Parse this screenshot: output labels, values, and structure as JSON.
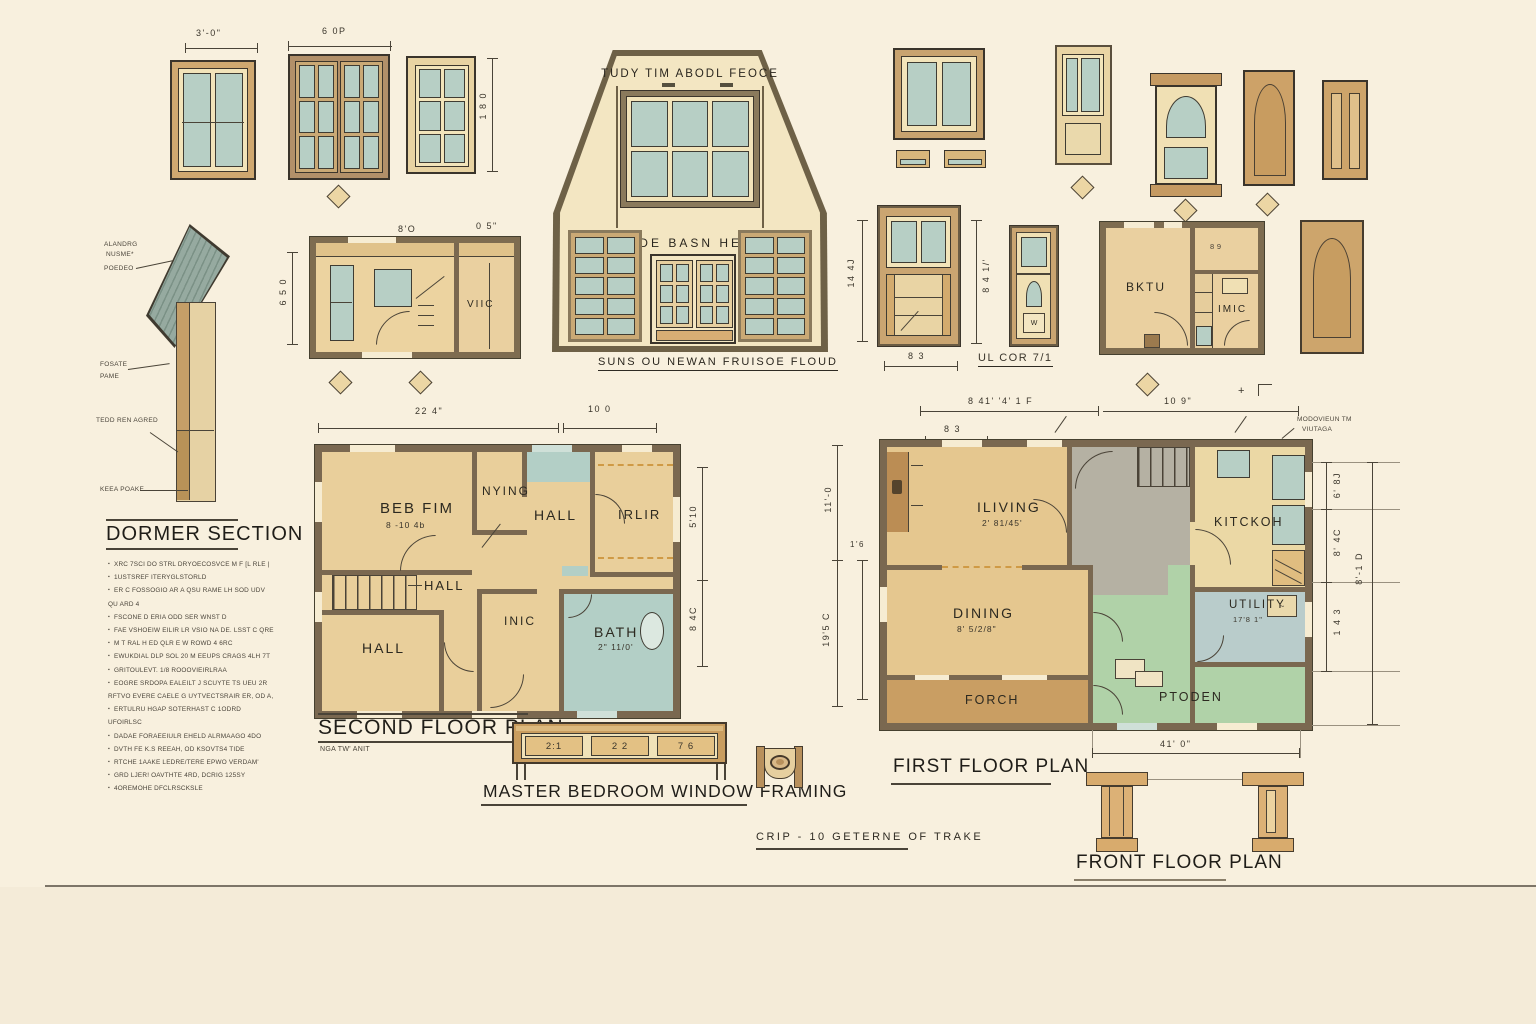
{
  "palette": {
    "paper": "#f8f0de",
    "wall": "#7a6850",
    "glass": "#b7cfc5",
    "green": "#b0d2a8",
    "gray": "#b5b1a3"
  },
  "windows": {
    "dim_a": "3'-0\"",
    "dim_b": "6 0P",
    "dim_c": "1 8 0"
  },
  "elevation": {
    "top_text": "TUDY TIM ABODL FEOCE",
    "mid_text": "BUDE BASN HETE",
    "caption": "SUNS OU NEWAN FRUISOE FLOUD"
  },
  "dormer": {
    "title": "DORMER SECTION",
    "callouts": [
      "ALANDRG",
      "NUSME*",
      "POEDEO",
      "FOSATE",
      "PAME",
      "TEDD REN AGRED",
      "KEEA POAKE"
    ],
    "notes": [
      "XRC 7SCI DO STRL DRYOECOSVCE M F  [L RLE |",
      "1USTSREF  ITERYGLSTORLD",
      "ER C FOSSOGIO AR A QSU RAME LH SOD UDV QU ARD 4",
      "FSCONE D ERIA ODD SER WNST D",
      "FAE VSHOEIW EILIR LR VSIO NA DE. LSST C QRE",
      "M T RAL H ED QLR E W ROWD 4 6RC",
      "EWUKDIAL DLP SOL 20 M EEUPS CRAGS 4LH 7T",
      "GRITOULEVT.  1/8 ROOOVIEIRLRAA",
      "EOGRE SRDOPA EALEILT J SCUYTE TS UEU 2R RFTVO EVERE CAELE G UYTVECTSRAIR ER, OD A,",
      "ERTULRU HGAP SOTERHAST C 1ODRD UFOIRLSC",
      "DADAE FORAEEIULR EHELD ALRMAAGO 4DO",
      "DVTH FE K.S REEAH, OD KSOVTS4 TIDE",
      "RTCHE 1AAKE LEDRE/TERE EPWO VERDAM'",
      "GRD LJER! OAVTHTE 4RD, DCRIG 125SY",
      "4OREMOHE DFCLRSCKSLE"
    ]
  },
  "small_plan": {
    "room": "VIIC",
    "dim_w": "8'O",
    "dim_w2": "0 5\"",
    "dim_h": "6 5 0"
  },
  "framing_elev": {
    "dim_left": "14 4J",
    "dim_right": "8 4 1/'",
    "dim_bottom": "8 3"
  },
  "ul_door": {
    "caption": "UL COR 7/1",
    "w_mark": "W"
  },
  "bktu_plan": {
    "room_a": "BKTU",
    "room_b": "IMIC",
    "dim": "8 9"
  },
  "second_floor": {
    "title": "SECOND FLOOR PLAN",
    "subtitle": "NGA TW' ANIT",
    "dim_top_a": "22 4\"",
    "dim_top_b": "10 0",
    "dim_right_a": "5'10",
    "dim_right_b": "8 4C",
    "rooms": {
      "bed": "BEB FIM",
      "bed_size": "8 -10 4b",
      "nying": "NYING",
      "hall_top": "HALL",
      "irlir": "IRLIR",
      "hall_mid": "HALL",
      "hall_bottom": "HALL",
      "inic": "INIC",
      "bath": "BATH",
      "bath_size": "2\" 11/0'"
    }
  },
  "master_framing": {
    "title": "MASTER BEDROOM WINDOW FRAMING",
    "panels": [
      "2:1",
      "2 2",
      "7 6"
    ]
  },
  "crip_note": "CRIP - 10  GETERNE  OF TRAKE",
  "first_floor": {
    "title": "FIRST FLOOR PLAN",
    "rooms": {
      "living": "ILIVING",
      "living_size": "2' 81/45'",
      "kitchen": "KITCKOH",
      "dining": "DINING",
      "dining_size": "8' 5/2/8\"",
      "utility": "UTILITY",
      "utility_size": "17'8 1\"",
      "utility_box": "~",
      "ptoden": "PTODEN",
      "porch": "FORCH"
    },
    "dims": {
      "top_a": "8 41'  '4' 1 F",
      "top_b": "10 9\"",
      "small": "8 3",
      "left_a": "11'-0",
      "left_b": "1'6",
      "left_c": "19'5 C",
      "right_a": "6' 8J",
      "right_b": "8' 4C",
      "right_c": "1 4 3",
      "right_d": "8'-1 D",
      "bottom": "41' 0\"",
      "plus": "+",
      "note_1": "MODOVIEUN TM",
      "note_2": "VIUTAGA"
    }
  },
  "front_floor": {
    "title": "FRONT FLOOR PLAN"
  }
}
